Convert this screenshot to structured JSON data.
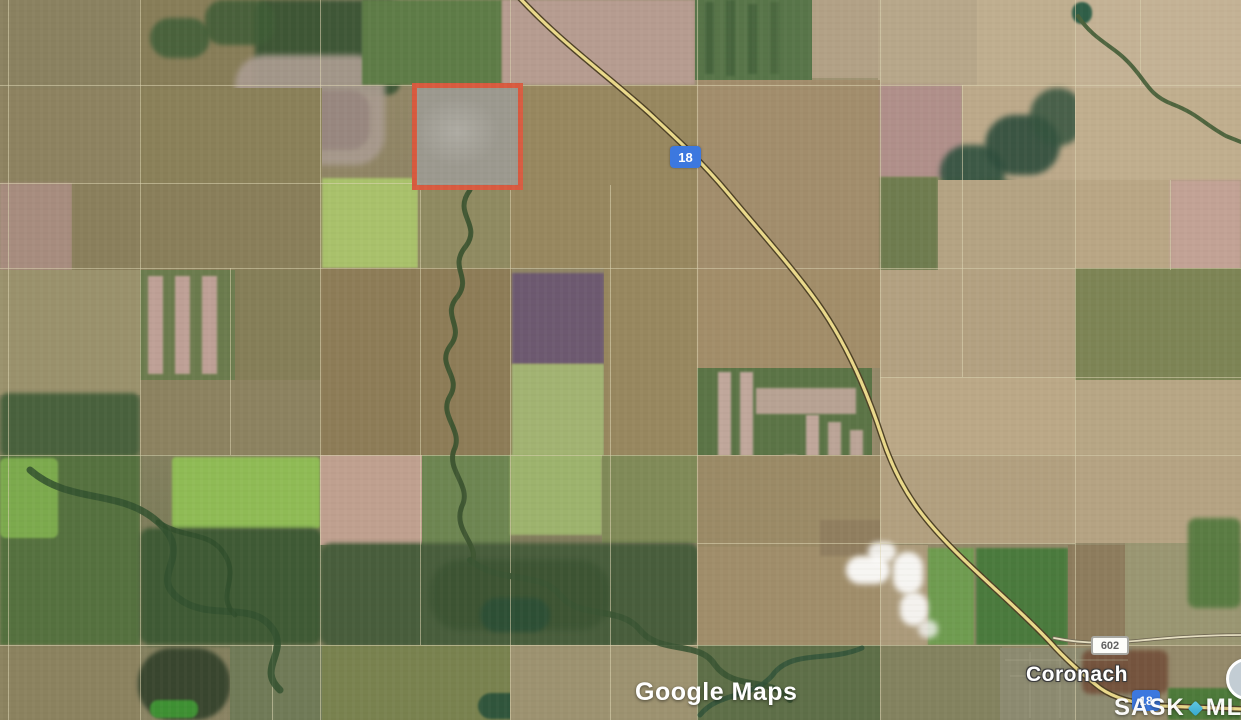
{
  "map": {
    "route_badges": {
      "highway_top": "18",
      "highway_bottom": "18",
      "road": "602"
    },
    "labels": {
      "town": "Coronach"
    },
    "watermarks": {
      "google": "Google Maps",
      "mls_left": "SASK",
      "mls_right": "MLS"
    }
  },
  "colors": {
    "shield_blue": "#3c78df",
    "shield_text": "#ffffff",
    "parcel_outline": "#d85a3f",
    "highway_fill": "#ead98b",
    "mls_diamond": "#35a8cf",
    "road_badge_text": "#616161"
  },
  "terrain": {
    "patches": [
      [
        0,
        0,
        140,
        88,
        "#8a8160",
        0,
        0,
        1
      ],
      [
        0,
        88,
        140,
        95,
        "#8d8260",
        0,
        0,
        1
      ],
      [
        0,
        183,
        72,
        87,
        "#a78c7e",
        0,
        1,
        1
      ],
      [
        72,
        183,
        68,
        87,
        "#8a7f5c",
        0,
        0,
        1
      ],
      [
        140,
        0,
        182,
        88,
        "#877d58",
        0,
        0,
        1
      ],
      [
        255,
        0,
        145,
        95,
        "#375232",
        12,
        2,
        0.9
      ],
      [
        150,
        18,
        60,
        40,
        "#44603a",
        20,
        2,
        0.9
      ],
      [
        205,
        0,
        70,
        45,
        "#3f5c36",
        18,
        2,
        0.85
      ],
      [
        235,
        55,
        150,
        110,
        "#a89a8e",
        30,
        3,
        0.95
      ],
      [
        300,
        90,
        70,
        60,
        "#97867e",
        20,
        2,
        0.9
      ],
      [
        362,
        0,
        140,
        85,
        "#5e7c47",
        0,
        1,
        1
      ],
      [
        502,
        0,
        193,
        85,
        "#b69c90",
        0,
        1,
        1
      ],
      [
        695,
        0,
        117,
        80,
        "#587549",
        0,
        0,
        1
      ],
      [
        705,
        2,
        9,
        72,
        "#46633c",
        0,
        1,
        0.9
      ],
      [
        726,
        0,
        9,
        76,
        "#46633c",
        0,
        1,
        0.9
      ],
      [
        748,
        4,
        9,
        70,
        "#46633c",
        0,
        1,
        0.9
      ],
      [
        770,
        2,
        9,
        72,
        "#4a673e",
        0,
        1,
        0.8
      ],
      [
        812,
        0,
        66,
        78,
        "#b2a186",
        0,
        0,
        1
      ],
      [
        878,
        0,
        99,
        85,
        "#b7a78a",
        0,
        0,
        1
      ],
      [
        977,
        0,
        98,
        85,
        "#bfae8f",
        0,
        0,
        1
      ],
      [
        1075,
        0,
        166,
        88,
        "#c4b295",
        0,
        0,
        1
      ],
      [
        1072,
        2,
        20,
        22,
        "#2f5e47",
        40,
        1,
        1
      ],
      [
        140,
        88,
        182,
        95,
        "#8a8059",
        0,
        0,
        1
      ],
      [
        140,
        183,
        182,
        87,
        "#897e5a",
        0,
        0,
        1
      ],
      [
        322,
        178,
        96,
        90,
        "#a9c16b",
        0,
        1,
        1
      ],
      [
        418,
        190,
        94,
        78,
        "#8f8a61",
        0,
        0,
        1
      ],
      [
        510,
        85,
        187,
        183,
        "#97875f",
        0,
        0,
        1
      ],
      [
        697,
        80,
        183,
        190,
        "#a28d6c",
        0,
        0,
        1
      ],
      [
        880,
        85,
        82,
        92,
        "#b08f8a",
        0,
        1,
        1
      ],
      [
        962,
        85,
        113,
        95,
        "#bca98a",
        0,
        0,
        1
      ],
      [
        940,
        145,
        65,
        55,
        "#30513f",
        40,
        3,
        0.9
      ],
      [
        985,
        115,
        75,
        60,
        "#2e4d3c",
        40,
        3,
        0.9
      ],
      [
        1030,
        88,
        55,
        58,
        "#35543f",
        40,
        3,
        0.85
      ],
      [
        965,
        180,
        60,
        45,
        "#37553d",
        40,
        3,
        0.85
      ],
      [
        880,
        177,
        58,
        93,
        "#6f7c4f",
        0,
        1,
        1
      ],
      [
        938,
        180,
        137,
        90,
        "#b4a383",
        0,
        0,
        1
      ],
      [
        1075,
        88,
        166,
        92,
        "#c0ae8e",
        0,
        0,
        1
      ],
      [
        1075,
        180,
        95,
        90,
        "#b9a685",
        0,
        0,
        1
      ],
      [
        1170,
        180,
        71,
        90,
        "#c2a295",
        0,
        1,
        1
      ],
      [
        0,
        270,
        140,
        125,
        "#9a916c",
        0,
        0,
        1
      ],
      [
        0,
        393,
        140,
        64,
        "#49613d",
        8,
        2,
        1
      ],
      [
        140,
        270,
        95,
        110,
        "#6b7b4d",
        0,
        0,
        1
      ],
      [
        148,
        276,
        15,
        98,
        "#c3a39a",
        0,
        1,
        0.95
      ],
      [
        175,
        276,
        15,
        98,
        "#c3a39a",
        0,
        1,
        0.95
      ],
      [
        202,
        276,
        15,
        98,
        "#c3a39a",
        0,
        1,
        0.95
      ],
      [
        235,
        270,
        85,
        110,
        "#857e58",
        0,
        0,
        1
      ],
      [
        140,
        380,
        180,
        75,
        "#8c8260",
        0,
        0,
        1
      ],
      [
        320,
        268,
        192,
        187,
        "#8d7c57",
        0,
        0,
        1
      ],
      [
        512,
        273,
        92,
        91,
        "#6d5970",
        0,
        1,
        1
      ],
      [
        512,
        364,
        92,
        94,
        "#a2b372",
        0,
        1,
        1
      ],
      [
        604,
        268,
        93,
        187,
        "#97875f",
        0,
        0,
        1
      ],
      [
        697,
        270,
        183,
        98,
        "#a28d69",
        0,
        0,
        1
      ],
      [
        697,
        368,
        175,
        177,
        "#5b7446",
        0,
        0,
        1
      ],
      [
        718,
        372,
        13,
        92,
        "#c6aaa0",
        0,
        1,
        0.95
      ],
      [
        740,
        372,
        13,
        92,
        "#c6aaa0",
        0,
        1,
        0.95
      ],
      [
        756,
        388,
        100,
        26,
        "#c2a79c",
        0,
        1,
        0.9
      ],
      [
        806,
        415,
        13,
        128,
        "#c6aaa0",
        0,
        1,
        0.95
      ],
      [
        828,
        422,
        13,
        120,
        "#c6aaa0",
        0,
        1,
        0.9
      ],
      [
        850,
        430,
        13,
        112,
        "#c6aaa0",
        0,
        1,
        0.9
      ],
      [
        784,
        455,
        13,
        88,
        "#c6aaa0",
        0,
        1,
        0.85
      ],
      [
        880,
        270,
        195,
        107,
        "#b3a181",
        0,
        0,
        1
      ],
      [
        880,
        377,
        195,
        78,
        "#bba887",
        0,
        0,
        1
      ],
      [
        1075,
        268,
        166,
        112,
        "#7d8455",
        0,
        0,
        1
      ],
      [
        1075,
        380,
        166,
        75,
        "#b7a685",
        0,
        0,
        1
      ],
      [
        0,
        455,
        140,
        190,
        "#55713f",
        0,
        1,
        1
      ],
      [
        0,
        458,
        58,
        80,
        "#7fae4e",
        6,
        1,
        0.95
      ],
      [
        172,
        457,
        148,
        72,
        "#8fbb55",
        4,
        1,
        1
      ],
      [
        140,
        528,
        182,
        117,
        "#3f5a35",
        10,
        2,
        1
      ],
      [
        320,
        455,
        102,
        90,
        "#bfa08f",
        0,
        0,
        1
      ],
      [
        422,
        455,
        88,
        90,
        "#6d8551",
        0,
        0,
        1
      ],
      [
        510,
        455,
        92,
        80,
        "#9db36d",
        0,
        1,
        1
      ],
      [
        602,
        455,
        95,
        88,
        "#808a58",
        0,
        0,
        1
      ],
      [
        320,
        543,
        380,
        104,
        "#485d3c",
        12,
        2,
        1
      ],
      [
        430,
        560,
        180,
        70,
        "#3c5433",
        30,
        3,
        0.9
      ],
      [
        480,
        598,
        70,
        34,
        "#2c4f36",
        40,
        2,
        0.9
      ],
      [
        697,
        455,
        183,
        92,
        "#9b8a66",
        0,
        0,
        1
      ],
      [
        697,
        547,
        183,
        98,
        "#a08d6a",
        0,
        0,
        1
      ],
      [
        820,
        520,
        70,
        36,
        "#8f7d5f",
        0,
        1,
        0.9
      ],
      [
        880,
        455,
        195,
        88,
        "#b2a07f",
        0,
        0,
        1
      ],
      [
        880,
        545,
        48,
        100,
        "#ab9a7a",
        0,
        0,
        1
      ],
      [
        928,
        548,
        46,
        97,
        "#6f9c50",
        0,
        1,
        1
      ],
      [
        976,
        548,
        92,
        97,
        "#4a7a3d",
        0,
        1,
        1
      ],
      [
        1068,
        545,
        58,
        100,
        "#8d7c5d",
        0,
        0,
        1
      ],
      [
        1075,
        455,
        166,
        88,
        "#b5a383",
        0,
        0,
        1
      ],
      [
        1125,
        543,
        116,
        102,
        "#9a9672",
        0,
        0,
        1
      ],
      [
        1188,
        518,
        53,
        90,
        "#567a40",
        8,
        2,
        0.95
      ],
      [
        0,
        645,
        140,
        75,
        "#8b825f",
        0,
        0,
        1
      ],
      [
        138,
        648,
        92,
        72,
        "#39462f",
        34,
        2,
        1
      ],
      [
        150,
        700,
        48,
        18,
        "#3f9434",
        8,
        1,
        0.95
      ],
      [
        230,
        645,
        92,
        75,
        "#707a57",
        0,
        0,
        1
      ],
      [
        322,
        645,
        188,
        75,
        "#79824f",
        0,
        0,
        1
      ],
      [
        478,
        693,
        58,
        26,
        "#29513a",
        40,
        1,
        0.9
      ],
      [
        510,
        645,
        187,
        75,
        "#9d9270",
        0,
        0,
        1
      ],
      [
        697,
        645,
        183,
        75,
        "#5e6f48",
        0,
        0,
        1
      ],
      [
        880,
        645,
        122,
        75,
        "#83825f",
        0,
        0,
        1
      ],
      [
        1000,
        648,
        132,
        72,
        "#8c8a70",
        0,
        0,
        1
      ],
      [
        1082,
        650,
        86,
        44,
        "#74523c",
        8,
        2,
        0.95
      ],
      [
        1168,
        688,
        73,
        32,
        "#4d7a3a",
        0,
        1,
        1
      ],
      [
        846,
        556,
        44,
        28,
        "#ffffff",
        50,
        3,
        0.92
      ],
      [
        868,
        542,
        28,
        20,
        "#ffffff",
        50,
        3,
        0.85
      ],
      [
        893,
        552,
        30,
        42,
        "#ffffff",
        50,
        3,
        0.9
      ],
      [
        900,
        592,
        28,
        34,
        "#ffffff",
        50,
        3,
        0.88
      ],
      [
        918,
        620,
        20,
        18,
        "#f4f4f2",
        50,
        3,
        0.8
      ]
    ],
    "vlines": [
      {
        "x": 8,
        "y1": 0,
        "y2": 720
      },
      {
        "x": 140,
        "y1": 0,
        "y2": 720
      },
      {
        "x": 230,
        "y1": 268,
        "y2": 455
      },
      {
        "x": 272,
        "y1": 645,
        "y2": 720
      },
      {
        "x": 320,
        "y1": 0,
        "y2": 720
      },
      {
        "x": 420,
        "y1": 183,
        "y2": 645
      },
      {
        "x": 510,
        "y1": 0,
        "y2": 720
      },
      {
        "x": 610,
        "y1": 185,
        "y2": 720
      },
      {
        "x": 697,
        "y1": 0,
        "y2": 720
      },
      {
        "x": 880,
        "y1": 0,
        "y2": 720
      },
      {
        "x": 962,
        "y1": 85,
        "y2": 377
      },
      {
        "x": 1075,
        "y1": 0,
        "y2": 720
      },
      {
        "x": 1140,
        "y1": 0,
        "y2": 85
      },
      {
        "x": 1170,
        "y1": 180,
        "y2": 270
      }
    ],
    "hlines": [
      {
        "y": 85,
        "x1": 0,
        "x2": 1241
      },
      {
        "y": 183,
        "x1": 0,
        "x2": 510
      },
      {
        "y": 268,
        "x1": 0,
        "x2": 1241
      },
      {
        "y": 377,
        "x1": 880,
        "x2": 1241
      },
      {
        "y": 455,
        "x1": 0,
        "x2": 1241
      },
      {
        "y": 543,
        "x1": 697,
        "x2": 1075
      },
      {
        "y": 645,
        "x1": 0,
        "x2": 1241
      }
    ]
  }
}
